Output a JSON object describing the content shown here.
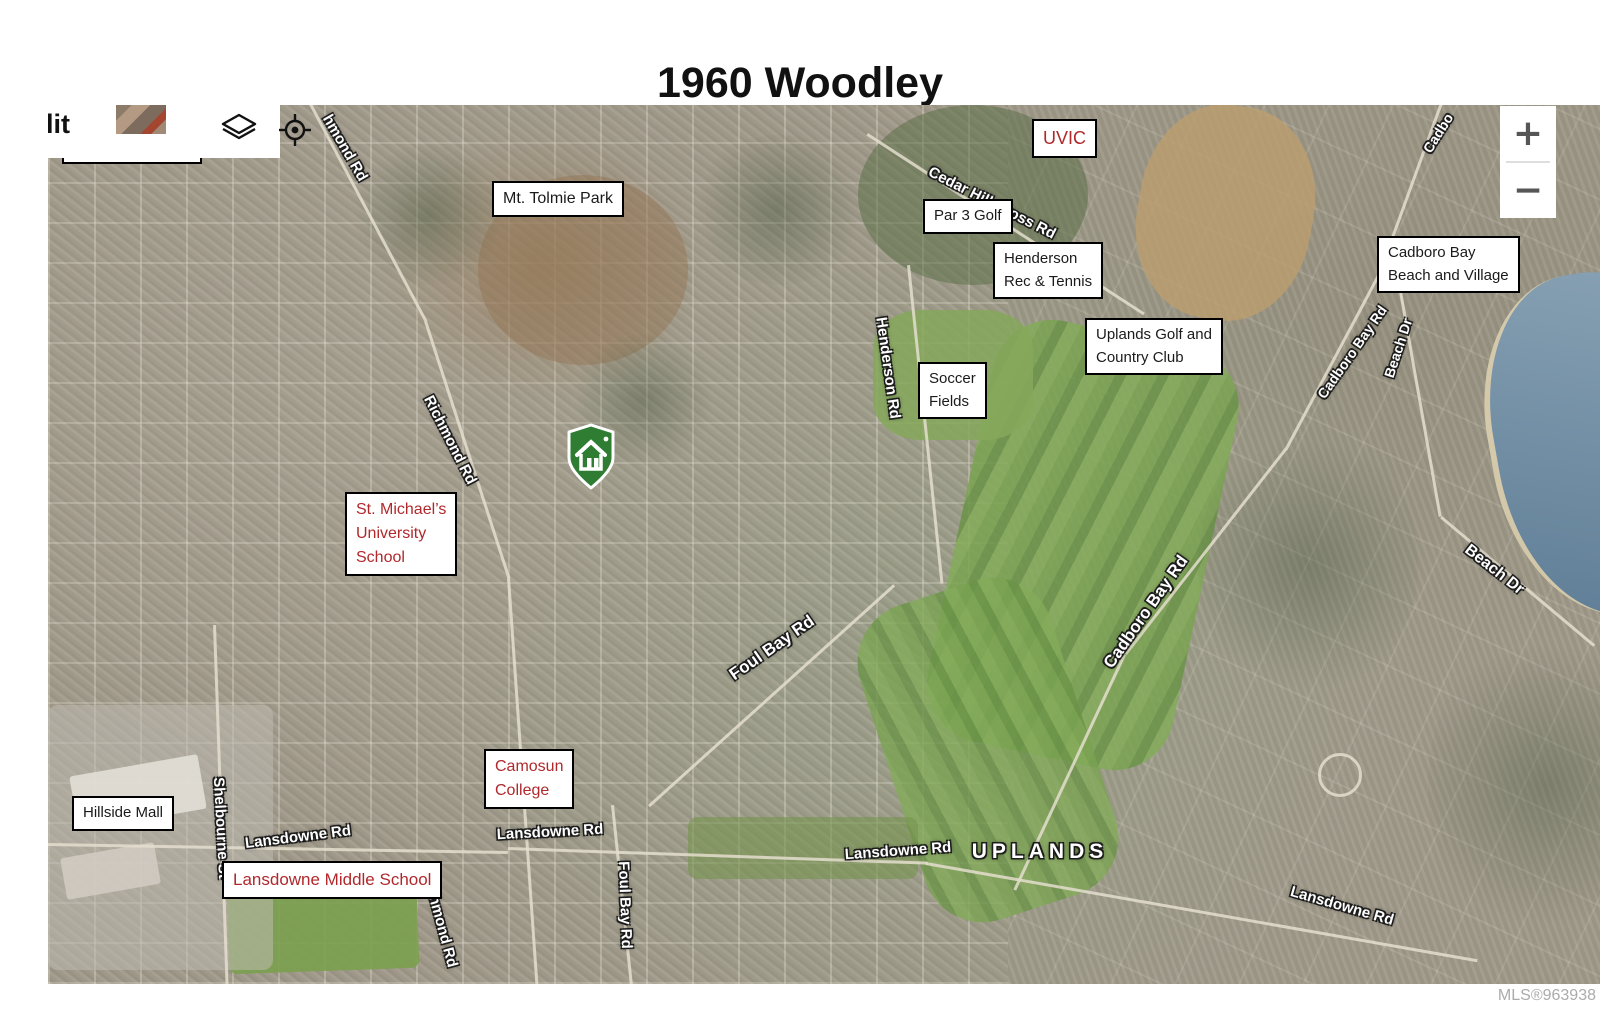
{
  "page": {
    "title": "1960 Woodley",
    "mls": "MLS®963938"
  },
  "colors": {
    "label_red": "#b0282c",
    "label_black": "#1a1a1a",
    "marker_green": "#2e7d33",
    "water": "#6f8ca3",
    "golf_green": "#7aa351"
  },
  "map_overlay": {
    "map_type_partial": "lit",
    "controls": {
      "zoom_in": "+",
      "zoom_out": "−"
    },
    "poi_labels": [
      {
        "id": "shelbourne-plaza",
        "lines": [
          "Shelbourne Plaza"
        ],
        "color": "black",
        "x": 14,
        "y": 24,
        "fs": 15
      },
      {
        "id": "mt-tolmie-park",
        "lines": [
          "Mt. Tolmie Park"
        ],
        "color": "black",
        "x": 444,
        "y": 76,
        "fs": 16
      },
      {
        "id": "uvic",
        "lines": [
          "UVIC"
        ],
        "color": "red",
        "x": 984,
        "y": 14,
        "fs": 18
      },
      {
        "id": "par-3-golf",
        "lines": [
          "Par 3 Golf"
        ],
        "color": "black",
        "x": 875,
        "y": 94,
        "fs": 15
      },
      {
        "id": "henderson-rec-tennis",
        "lines": [
          "Henderson",
          "Rec & Tennis"
        ],
        "color": "black",
        "x": 945,
        "y": 137,
        "fs": 15
      },
      {
        "id": "cadboro-bay-beach-village",
        "lines": [
          "Cadboro Bay",
          "Beach and Village"
        ],
        "color": "black",
        "x": 1329,
        "y": 131,
        "fs": 15
      },
      {
        "id": "uplands-golf-country-club",
        "lines": [
          "Uplands Golf and",
          "Country Club"
        ],
        "color": "black",
        "x": 1037,
        "y": 213,
        "fs": 15
      },
      {
        "id": "soccer-fields",
        "lines": [
          "Soccer",
          "Fields"
        ],
        "color": "black",
        "x": 870,
        "y": 257,
        "fs": 15
      },
      {
        "id": "st-michaels-university-school",
        "lines": [
          "St. Michael’s",
          "University",
          "School"
        ],
        "color": "red",
        "x": 297,
        "y": 387,
        "fs": 16
      },
      {
        "id": "camosun-college",
        "lines": [
          "Camosun",
          "College"
        ],
        "color": "red",
        "x": 436,
        "y": 644,
        "fs": 16
      },
      {
        "id": "hillside-mall",
        "lines": [
          "Hillside Mall"
        ],
        "color": "black",
        "x": 24,
        "y": 691,
        "fs": 15
      },
      {
        "id": "lansdowne-middle-school",
        "lines": [
          "Lansdowne Middle School"
        ],
        "color": "red",
        "x": 174,
        "y": 756,
        "fs": 17
      }
    ],
    "road_labels": [
      {
        "id": "richmond-rd-top",
        "text": "hmond Rd",
        "x": 297,
        "y": 43,
        "rot": 60,
        "fs": 15,
        "kind": "road"
      },
      {
        "id": "richmond-rd-mid",
        "text": "Richmond Rd",
        "x": 402,
        "y": 335,
        "rot": 63,
        "fs": 15,
        "kind": "road"
      },
      {
        "id": "richmond-rd-bottom",
        "text": "Richmond Rd",
        "x": 392,
        "y": 815,
        "rot": 75,
        "fs": 15,
        "kind": "road"
      },
      {
        "id": "cedar-hill-cross-rd",
        "text": "Cedar Hill Cross Rd",
        "x": 944,
        "y": 98,
        "rot": 27,
        "fs": 15,
        "kind": "road"
      },
      {
        "id": "henderson-rd",
        "text": "Henderson Rd",
        "x": 840,
        "y": 263,
        "rot": 82,
        "fs": 15,
        "kind": "road"
      },
      {
        "id": "foul-bay-rd-diag",
        "text": "Foul Bay Rd",
        "x": 724,
        "y": 543,
        "rot": -35,
        "fs": 17,
        "kind": "road"
      },
      {
        "id": "foul-bay-rd-vert",
        "text": "Foul Bay Rd",
        "x": 577,
        "y": 800,
        "rot": 88,
        "fs": 15,
        "kind": "road"
      },
      {
        "id": "shelbourne-st",
        "text": "Shelbourne St",
        "x": 173,
        "y": 723,
        "rot": 87,
        "fs": 15,
        "kind": "road"
      },
      {
        "id": "lansdowne-rd-west",
        "text": "Lansdowne Rd",
        "x": 250,
        "y": 732,
        "rot": -7,
        "fs": 15,
        "kind": "road"
      },
      {
        "id": "lansdowne-rd-mid",
        "text": "Lansdowne Rd",
        "x": 502,
        "y": 727,
        "rot": -3,
        "fs": 15,
        "kind": "road"
      },
      {
        "id": "lansdowne-rd-center",
        "text": "Lansdowne Rd",
        "x": 850,
        "y": 746,
        "rot": -4,
        "fs": 15,
        "kind": "road"
      },
      {
        "id": "uplands-area",
        "text": "UPLANDS",
        "x": 992,
        "y": 747,
        "rot": 0,
        "fs": 21,
        "kind": "area"
      },
      {
        "id": "lansdowne-rd-se",
        "text": "Lansdowne Rd",
        "x": 1294,
        "y": 801,
        "rot": 16,
        "fs": 15,
        "kind": "road"
      },
      {
        "id": "cadboro-bay-rd-mid",
        "text": "Cadboro Bay Rd",
        "x": 1098,
        "y": 507,
        "rot": -55,
        "fs": 17,
        "kind": "road"
      },
      {
        "id": "cadboro-bay-rd-ne",
        "text": "Cadboro Bay Rd",
        "x": 1304,
        "y": 247,
        "rot": -55,
        "fs": 14,
        "kind": "road"
      },
      {
        "id": "cadboro-bay-rd-top",
        "text": "Cadbo",
        "x": 1390,
        "y": 28,
        "rot": -58,
        "fs": 14,
        "kind": "road"
      },
      {
        "id": "beach-dr-north",
        "text": "Beach Dr",
        "x": 1350,
        "y": 243,
        "rot": -72,
        "fs": 14,
        "kind": "road"
      },
      {
        "id": "beach-dr-east",
        "text": "Beach Dr",
        "x": 1446,
        "y": 465,
        "rot": 38,
        "fs": 16,
        "kind": "road"
      }
    ]
  }
}
